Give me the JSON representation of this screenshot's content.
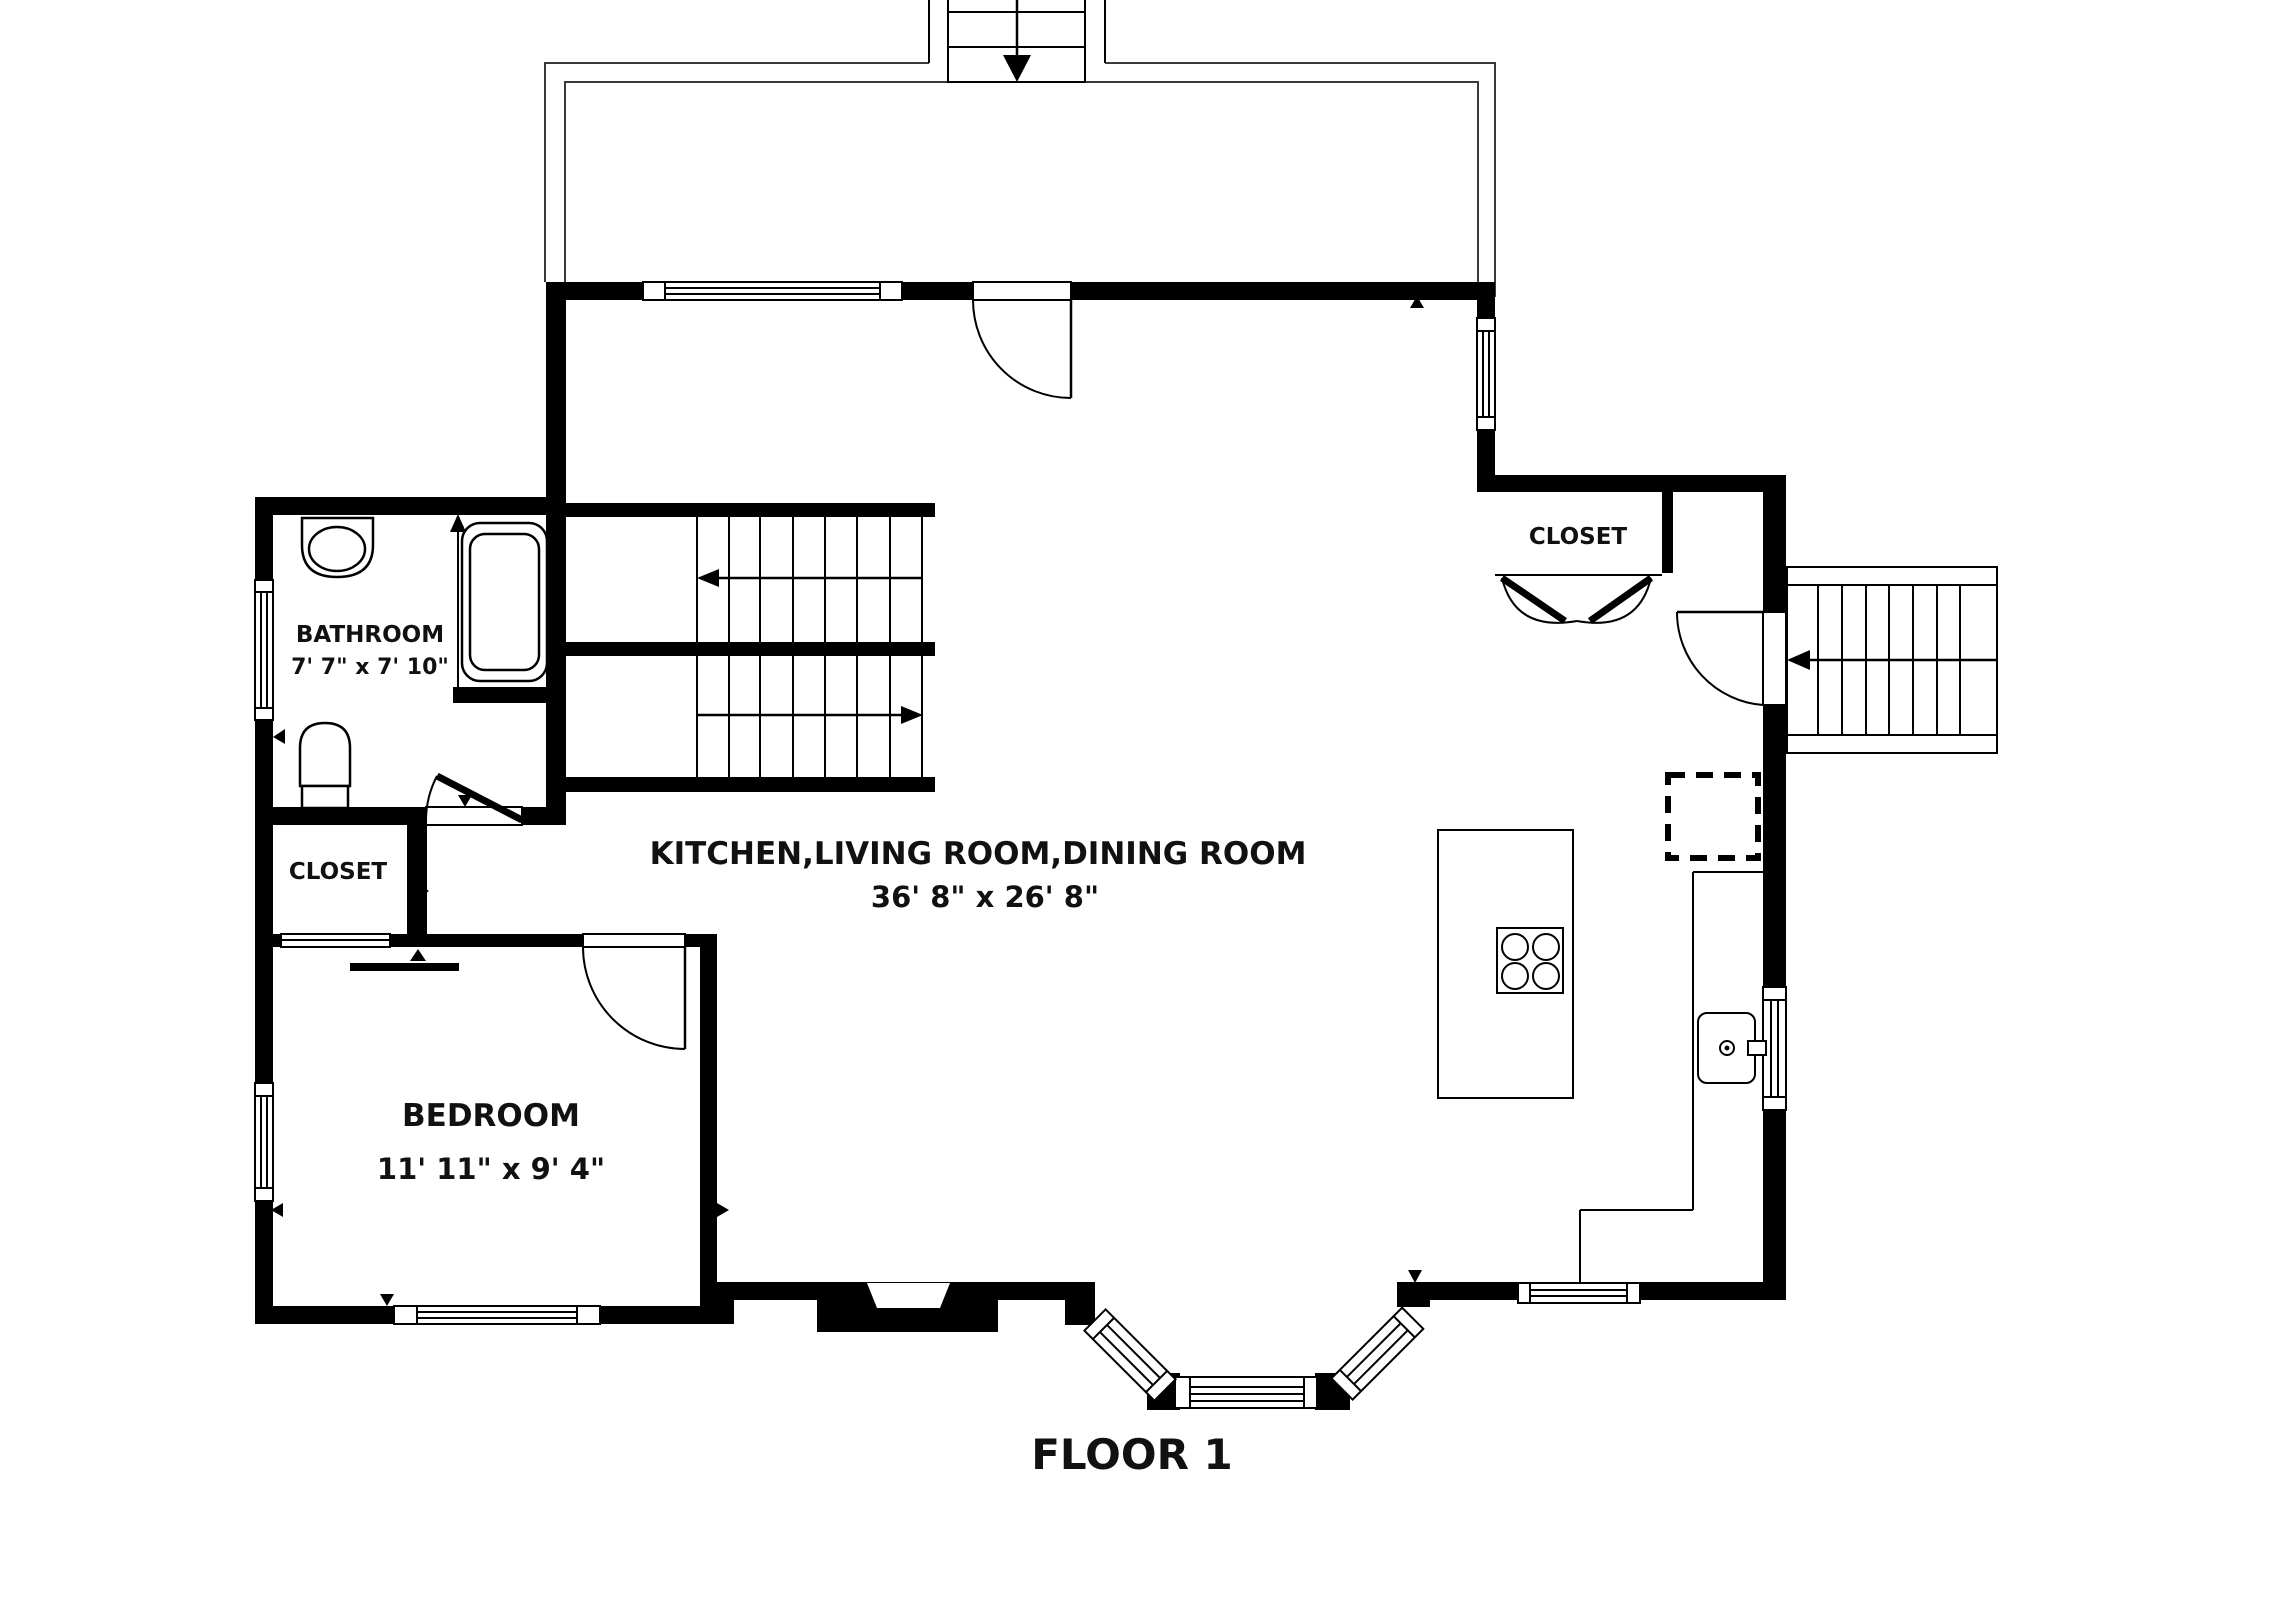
{
  "title": "FLOOR 1",
  "colors": {
    "wall": "#000000",
    "background": "#ffffff",
    "deck_outline": "#3a3a3a"
  },
  "rooms": [
    {
      "name": "BATHROOM",
      "dimensions": "7' 7\" x 7' 10\""
    },
    {
      "name": "CLOSET",
      "dimensions": ""
    },
    {
      "name": "KITCHEN,LIVING ROOM,DINING ROOM",
      "dimensions": "36' 8\" x 26' 8\""
    },
    {
      "name": "CLOSET",
      "dimensions": ""
    },
    {
      "name": "BEDROOM",
      "dimensions": "11' 11\" x 9' 4\""
    }
  ],
  "fixtures": {
    "bathroom": [
      "corner-sink-icon",
      "bathtub-icon",
      "toilet-icon"
    ],
    "kitchen": [
      "island-icon",
      "cooktop-4-burner-icon",
      "kitchen-sink-icon",
      "counter-icon",
      "dashed-appliance-icon"
    ],
    "exterior": [
      "deck-icon",
      "deck-stairs-down-icon",
      "exterior-stairs-icon",
      "entry-stoop-icon",
      "bay-window-icon"
    ],
    "circulation": [
      "interior-staircase-up-icon",
      "interior-staircase-down-icon"
    ]
  }
}
